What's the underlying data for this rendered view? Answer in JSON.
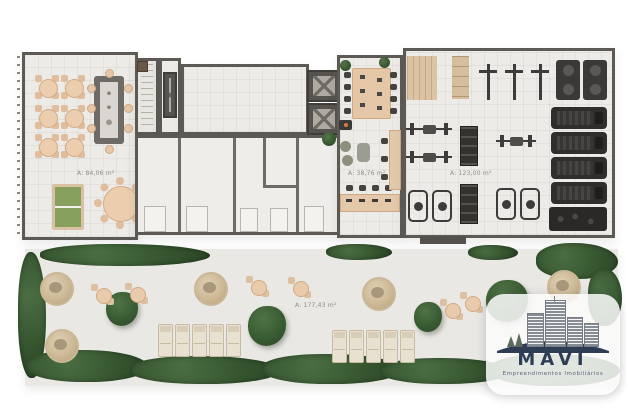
{
  "plan": {
    "rooms": {
      "lounge": {
        "area_label": "A: 84,06 m²"
      },
      "coworking": {
        "area_label": "A: 38,76 m²"
      },
      "gym": {
        "area_label": "A: 123,00 m²"
      },
      "terrace": {
        "area_label": "A: 177,43 m²"
      }
    }
  },
  "logo": {
    "name": "MAVI",
    "tagline": "Empreendimentos Imobiliários"
  },
  "colors": {
    "wall": "#5d5a55",
    "floor": "#edebe7",
    "terrace_floor": "#eae8e4",
    "furniture_beige": "#e6c8a9",
    "wood": "#d9c2a3",
    "hedge_green": "#35552f",
    "pingpong_green": "#87a05e",
    "gym_equipment": "#3a3836",
    "logo_navy": "#2e3c55"
  }
}
